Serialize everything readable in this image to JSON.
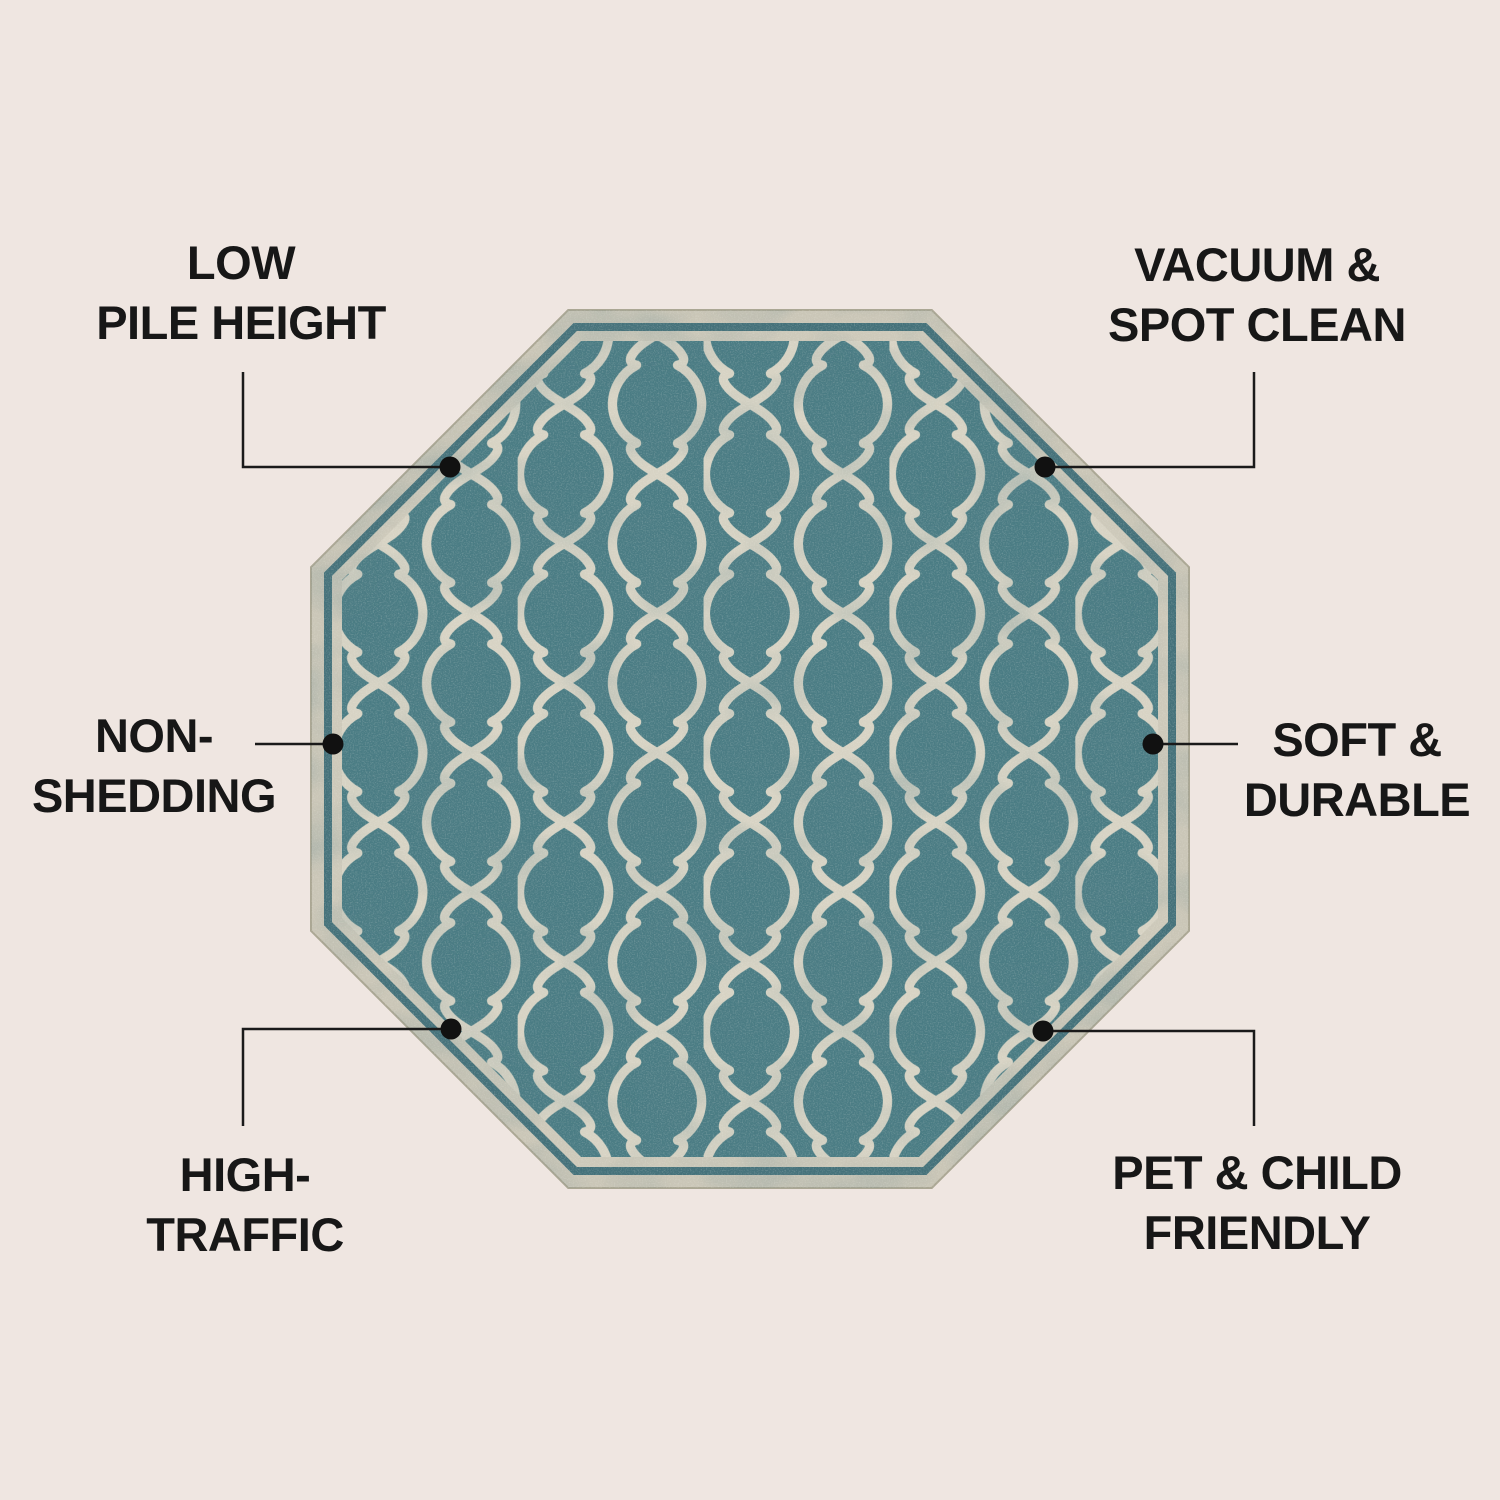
{
  "page": {
    "background_color": "#efe6e1",
    "text_color": "#171717"
  },
  "rug": {
    "shape": "octagon",
    "pattern_name": "moroccan-trellis-quatrefoil",
    "field_color": "#4a7c84",
    "pattern_color": "#d7d3c4",
    "border_band_color": "#cac6b7",
    "border_stripe_color": "#44717a",
    "inner_stripe_color": "#cdc9ba"
  },
  "connectors": {
    "line_color": "#1a1a1a",
    "dot_color": "#111111"
  },
  "callouts": [
    {
      "id": "low-pile-height",
      "lines": [
        "LOW",
        "PILE HEIGHT"
      ]
    },
    {
      "id": "vacuum-spot-clean",
      "lines": [
        "VACUUM &",
        "SPOT CLEAN"
      ]
    },
    {
      "id": "non-shedding",
      "lines": [
        "NON-",
        "SHEDDING"
      ]
    },
    {
      "id": "soft-durable",
      "lines": [
        "SOFT &",
        "DURABLE"
      ]
    },
    {
      "id": "high-traffic",
      "lines": [
        "HIGH-",
        "TRAFFIC"
      ]
    },
    {
      "id": "pet-child-friendly",
      "lines": [
        "PET & CHILD",
        "FRIENDLY"
      ]
    }
  ]
}
